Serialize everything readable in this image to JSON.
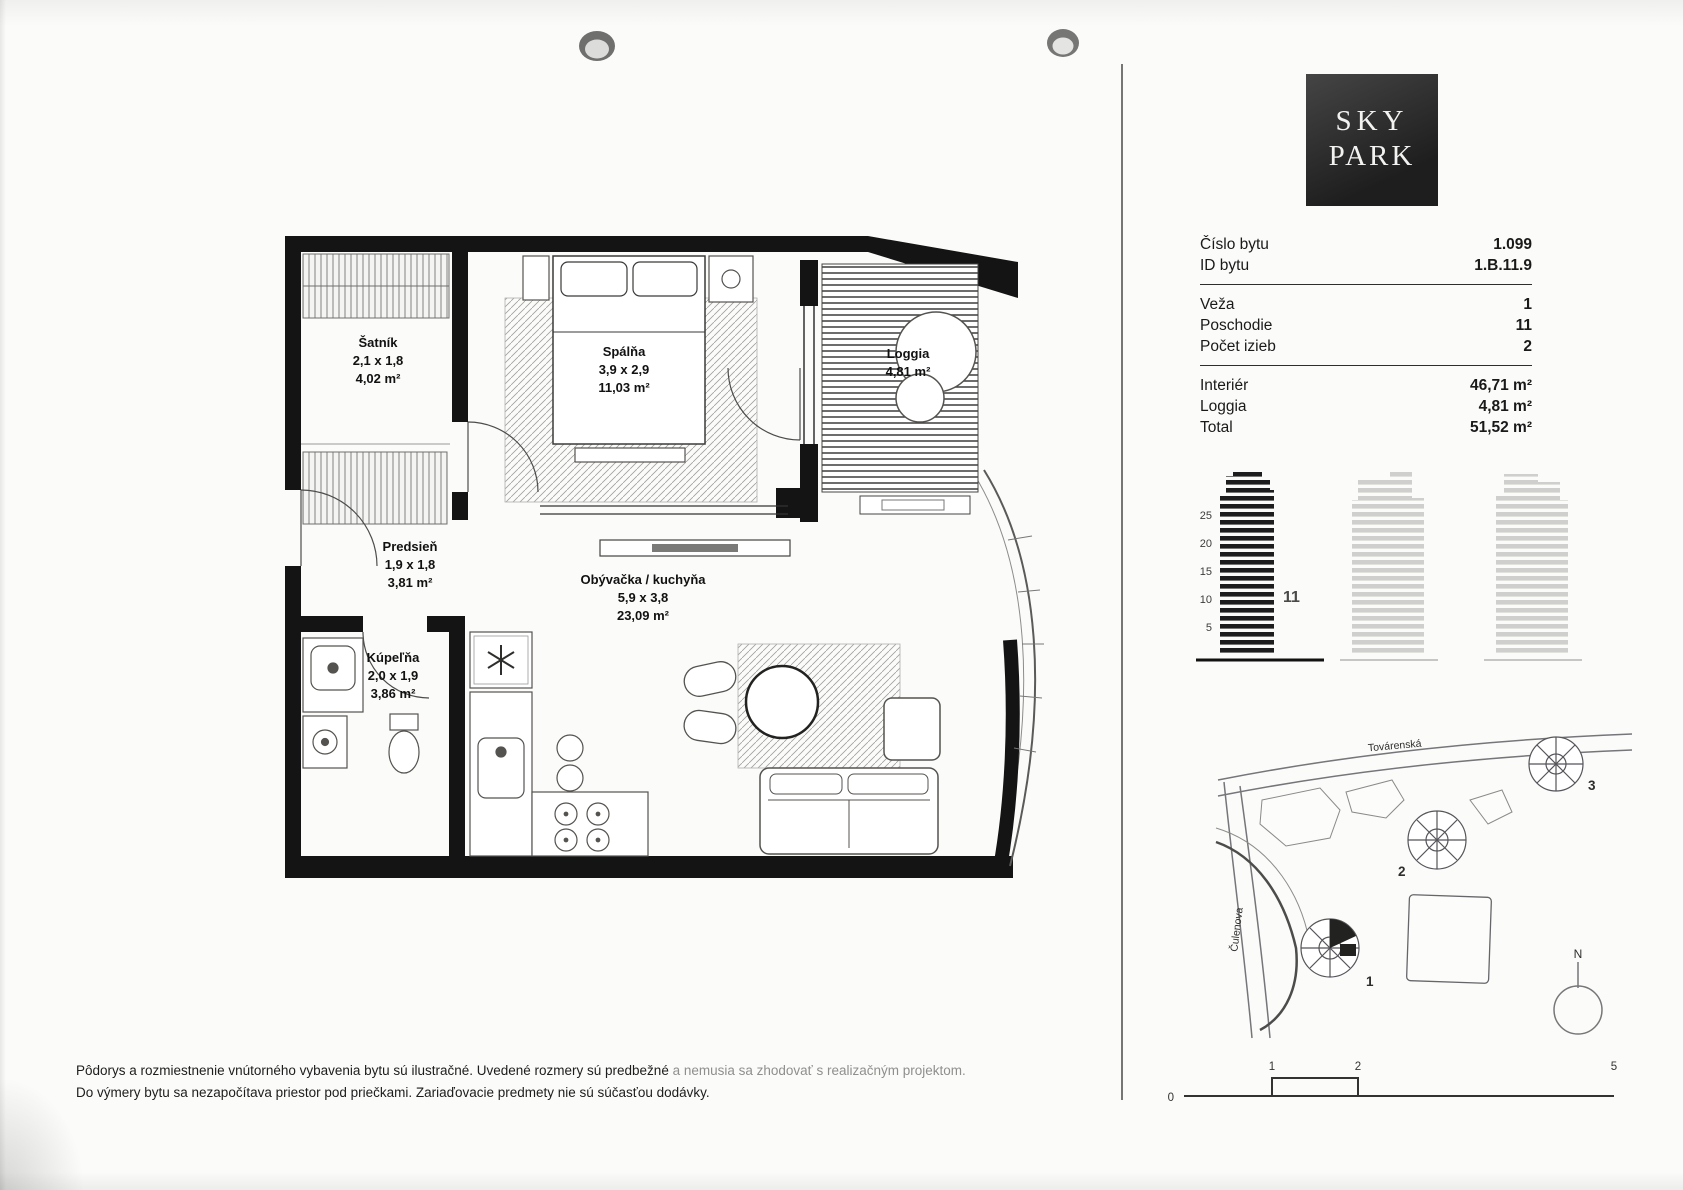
{
  "logo": {
    "line1": "SKY",
    "line2": "PARK"
  },
  "details": {
    "rows_group1": [
      {
        "label": "Číslo bytu",
        "value": "1.099"
      },
      {
        "label": "ID bytu",
        "value": "1.B.11.9"
      }
    ],
    "rows_group2": [
      {
        "label": "Veža",
        "value": "1"
      },
      {
        "label": "Poschodie",
        "value": "11"
      },
      {
        "label": "Počet izieb",
        "value": "2"
      }
    ],
    "rows_group3": [
      {
        "label": "Interiér",
        "value": "46,71 m²"
      },
      {
        "label": "Loggia",
        "value": "4,81 m²"
      },
      {
        "label": "Total",
        "value": "51,52 m²"
      }
    ]
  },
  "floorplan": {
    "rooms": [
      {
        "name": "Šatník",
        "dims": "2,1 x 1,8",
        "area": "4,02 m²"
      },
      {
        "name": "Spálňa",
        "dims": "3,9 x 2,9",
        "area": "11,03 m²"
      },
      {
        "name": "Loggia",
        "dims": "",
        "area": "4,81 m²"
      },
      {
        "name": "Predsieň",
        "dims": "1,9 x 1,8",
        "area": "3,81 m²"
      },
      {
        "name": "Kúpeľňa",
        "dims": "2,0 x 1,9",
        "area": "3,86 m²"
      },
      {
        "name": "Obývačka / kuchyňa",
        "dims": "5,9 x 3,8",
        "area": "23,09 m²"
      }
    ]
  },
  "elevation": {
    "ticks": [
      "25",
      "20",
      "15",
      "10",
      "5"
    ],
    "floor_label": "11"
  },
  "site_map": {
    "street_top": "Továrenská",
    "street_left": "Čulenova",
    "tower1": "1",
    "tower2": "2",
    "tower3": "3",
    "north": "N"
  },
  "scale_bar": {
    "t0": "0",
    "t1": "1",
    "t2": "2",
    "t5": "5"
  },
  "disclaimer": {
    "line1_main": "Pôdorys a rozmiestnenie vnútorného vybavenia bytu sú ilustračné. Uvedené rozmery sú predbežné ",
    "line1_faded": "a nemusia sa zhodovať s realizačným projektom.",
    "line2": "Do výmery bytu sa nezapočítava priestor pod priečkami. Zariaďovacie predmety nie sú súčasťou dodávky."
  },
  "colors": {
    "ink": "#141414",
    "accent_grey": "#555555"
  }
}
